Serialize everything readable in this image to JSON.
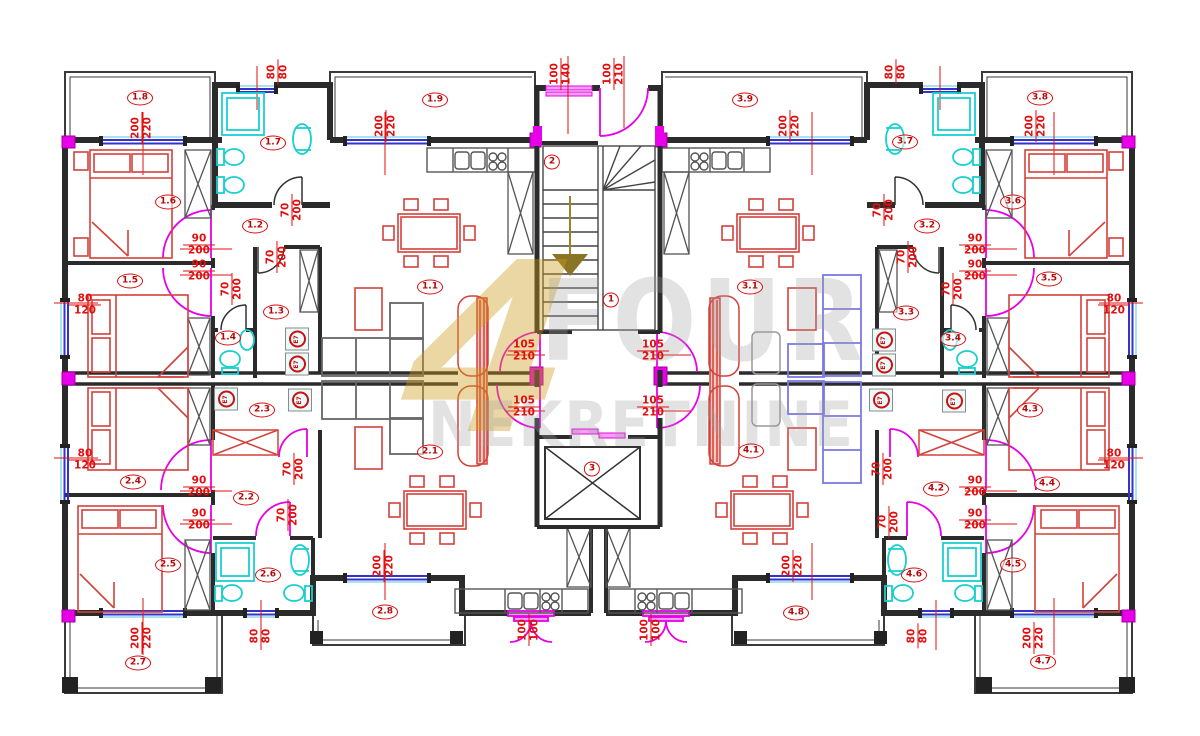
{
  "plan": {
    "watermark": {
      "logo": "4",
      "title": "FOUR",
      "subtitle": "NEKRETNINE"
    },
    "colors": {
      "wall": "#2b2b2b",
      "label_red": "#d90f0f",
      "door_magenta": "#e800e8",
      "window_blue": "#3333cc",
      "window_cyan": "#8fd8ee",
      "fixture_cyan": "#19cfcf",
      "furniture_red": "#d4403a",
      "sofa_blue": "#7a7ae0",
      "sofa_gray": "#666666",
      "watermark_gold": "#cd9b19",
      "stair_arrow_gold": "#8a7425"
    },
    "room_labels": [
      {
        "id": "1.8",
        "x": 140,
        "y": 98
      },
      {
        "id": "1.7",
        "x": 273,
        "y": 143
      },
      {
        "id": "1.9",
        "x": 435,
        "y": 100
      },
      {
        "id": "3.9",
        "x": 745,
        "y": 100
      },
      {
        "id": "3.7",
        "x": 905,
        "y": 142
      },
      {
        "id": "3.8",
        "x": 1040,
        "y": 98
      },
      {
        "id": "1.6",
        "x": 168,
        "y": 202
      },
      {
        "id": "1.2",
        "x": 255,
        "y": 226
      },
      {
        "id": "1.1",
        "x": 430,
        "y": 287
      },
      {
        "id": "3.1",
        "x": 750,
        "y": 287
      },
      {
        "id": "3.2",
        "x": 927,
        "y": 226
      },
      {
        "id": "3.6",
        "x": 1013,
        "y": 202
      },
      {
        "id": "1.5",
        "x": 130,
        "y": 281
      },
      {
        "id": "1.3",
        "x": 276,
        "y": 312
      },
      {
        "id": "1.4",
        "x": 228,
        "y": 338
      },
      {
        "id": "2",
        "x": 552,
        "y": 162
      },
      {
        "id": "1",
        "x": 611,
        "y": 300
      },
      {
        "id": "3",
        "x": 592,
        "y": 469
      },
      {
        "id": "3.3",
        "x": 906,
        "y": 313
      },
      {
        "id": "3.4",
        "x": 953,
        "y": 339
      },
      {
        "id": "3.5",
        "x": 1049,
        "y": 279
      },
      {
        "id": "2.3",
        "x": 262,
        "y": 410
      },
      {
        "id": "4.3",
        "x": 1030,
        "y": 410
      },
      {
        "id": "2.1",
        "x": 430,
        "y": 452
      },
      {
        "id": "4.1",
        "x": 751,
        "y": 451
      },
      {
        "id": "2.4",
        "x": 133,
        "y": 482
      },
      {
        "id": "2.2",
        "x": 246,
        "y": 498
      },
      {
        "id": "4.2",
        "x": 936,
        "y": 489
      },
      {
        "id": "4.4",
        "x": 1047,
        "y": 484
      },
      {
        "id": "2.5",
        "x": 168,
        "y": 565
      },
      {
        "id": "2.6",
        "x": 268,
        "y": 575
      },
      {
        "id": "4.6",
        "x": 914,
        "y": 575
      },
      {
        "id": "4.5",
        "x": 1013,
        "y": 565
      },
      {
        "id": "2.8",
        "x": 385,
        "y": 612
      },
      {
        "id": "4.8",
        "x": 796,
        "y": 613
      },
      {
        "id": "2.7",
        "x": 138,
        "y": 663
      },
      {
        "id": "4.7",
        "x": 1043,
        "y": 662
      }
    ],
    "dimension_labels": [
      {
        "a": "80",
        "b": "80",
        "x": 278,
        "y": 72,
        "rot": 90
      },
      {
        "a": "80",
        "b": "80",
        "x": 896,
        "y": 72,
        "rot": 90
      },
      {
        "a": "200",
        "b": "220",
        "x": 142,
        "y": 128,
        "rot": 90
      },
      {
        "a": "200",
        "b": "220",
        "x": 386,
        "y": 126,
        "rot": 90
      },
      {
        "a": "100",
        "b": "140",
        "x": 561,
        "y": 74,
        "rot": 90
      },
      {
        "a": "100",
        "b": "210",
        "x": 614,
        "y": 74,
        "rot": 90
      },
      {
        "a": "200",
        "b": "220",
        "x": 790,
        "y": 126,
        "rot": 90
      },
      {
        "a": "200",
        "b": "220",
        "x": 1036,
        "y": 126,
        "rot": 90
      },
      {
        "a": "80",
        "b": "120",
        "x": 85,
        "y": 305,
        "rot": 0
      },
      {
        "a": "80",
        "b": "120",
        "x": 85,
        "y": 460,
        "rot": 0
      },
      {
        "a": "80",
        "b": "120",
        "x": 1114,
        "y": 305,
        "rot": 0
      },
      {
        "a": "80",
        "b": "120",
        "x": 1114,
        "y": 460,
        "rot": 0
      },
      {
        "a": "90",
        "b": "200",
        "x": 199,
        "y": 245,
        "rot": 0
      },
      {
        "a": "90",
        "b": "200",
        "x": 199,
        "y": 271,
        "rot": 0
      },
      {
        "a": "90",
        "b": "200",
        "x": 975,
        "y": 245,
        "rot": 0
      },
      {
        "a": "90",
        "b": "200",
        "x": 975,
        "y": 271,
        "rot": 0
      },
      {
        "a": "90",
        "b": "200",
        "x": 199,
        "y": 487,
        "rot": 0
      },
      {
        "a": "90",
        "b": "200",
        "x": 199,
        "y": 520,
        "rot": 0
      },
      {
        "a": "90",
        "b": "200",
        "x": 975,
        "y": 487,
        "rot": 0
      },
      {
        "a": "90",
        "b": "200",
        "x": 975,
        "y": 520,
        "rot": 0
      },
      {
        "a": "105",
        "b": "210",
        "x": 524,
        "y": 351,
        "rot": 0
      },
      {
        "a": "105",
        "b": "210",
        "x": 524,
        "y": 407,
        "rot": 0
      },
      {
        "a": "105",
        "b": "210",
        "x": 653,
        "y": 351,
        "rot": 0
      },
      {
        "a": "105",
        "b": "210",
        "x": 653,
        "y": 407,
        "rot": 0
      },
      {
        "a": "70",
        "b": "200",
        "x": 292,
        "y": 210,
        "rot": 90
      },
      {
        "a": "70",
        "b": "200",
        "x": 277,
        "y": 257,
        "rot": 90
      },
      {
        "a": "70",
        "b": "200",
        "x": 232,
        "y": 289,
        "rot": 90
      },
      {
        "a": "70",
        "b": "200",
        "x": 294,
        "y": 469,
        "rot": 90
      },
      {
        "a": "70",
        "b": "200",
        "x": 288,
        "y": 515,
        "rot": 90
      },
      {
        "a": "70",
        "b": "200",
        "x": 884,
        "y": 210,
        "rot": 90
      },
      {
        "a": "70",
        "b": "200",
        "x": 908,
        "y": 257,
        "rot": 90
      },
      {
        "a": "70",
        "b": "200",
        "x": 953,
        "y": 289,
        "rot": 90
      },
      {
        "a": "70",
        "b": "200",
        "x": 883,
        "y": 469,
        "rot": 90
      },
      {
        "a": "70",
        "b": "200",
        "x": 889,
        "y": 522,
        "rot": 90
      },
      {
        "a": "200",
        "b": "220",
        "x": 142,
        "y": 638,
        "rot": 90
      },
      {
        "a": "80",
        "b": "80",
        "x": 261,
        "y": 636,
        "rot": 90
      },
      {
        "a": "200",
        "b": "220",
        "x": 384,
        "y": 566,
        "rot": 90
      },
      {
        "a": "200",
        "b": "220",
        "x": 793,
        "y": 566,
        "rot": 90
      },
      {
        "a": "80",
        "b": "80",
        "x": 918,
        "y": 636,
        "rot": 90
      },
      {
        "a": "200",
        "b": "220",
        "x": 1034,
        "y": 638,
        "rot": 90
      },
      {
        "a": "100",
        "b": "100",
        "x": 529,
        "y": 630,
        "rot": 90
      },
      {
        "a": "100",
        "b": "100",
        "x": 651,
        "y": 630,
        "rot": 90
      }
    ],
    "appliance_labels": [
      {
        "text": "E7",
        "x": 297,
        "y": 339
      },
      {
        "text": "E7",
        "x": 297,
        "y": 364
      },
      {
        "text": "E7",
        "x": 226,
        "y": 399
      },
      {
        "text": "E7",
        "x": 300,
        "y": 400
      },
      {
        "text": "E7",
        "x": 884,
        "y": 340
      },
      {
        "text": "E7",
        "x": 884,
        "y": 365
      },
      {
        "text": "E7",
        "x": 881,
        "y": 400
      },
      {
        "text": "E7",
        "x": 954,
        "y": 401
      }
    ]
  }
}
